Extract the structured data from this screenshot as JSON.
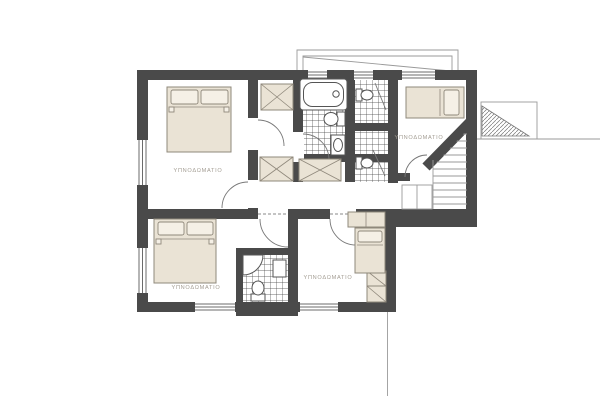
{
  "plan": {
    "type": "floor-plan",
    "rooms": [
      {
        "id": "bedroom-top-left",
        "label": "ΥΠΝΟΔΩΜΑΤΙΟ"
      },
      {
        "id": "bedroom-top-right",
        "label": "ΥΠΝΟΔΩΜΑΤΙΟ"
      },
      {
        "id": "bedroom-bottom-left",
        "label": "ΥΠΝΟΔΩΜΑΤΙΟ"
      },
      {
        "id": "bedroom-bottom-right",
        "label": "ΥΠΝΟΔΩΜΑΤΙΟ"
      }
    ]
  },
  "colors": {
    "wall": "#4a4a4a",
    "furniture_fill": "#eae3d5",
    "furniture_stroke": "#8f887b",
    "pillow_fill": "#f5f0e6",
    "line_thin": "#9a9a9a",
    "line_mid": "#6b6b6b",
    "tile_line": "#3f3f3f",
    "label_text": "#a39d93",
    "background": "#ffffff"
  }
}
